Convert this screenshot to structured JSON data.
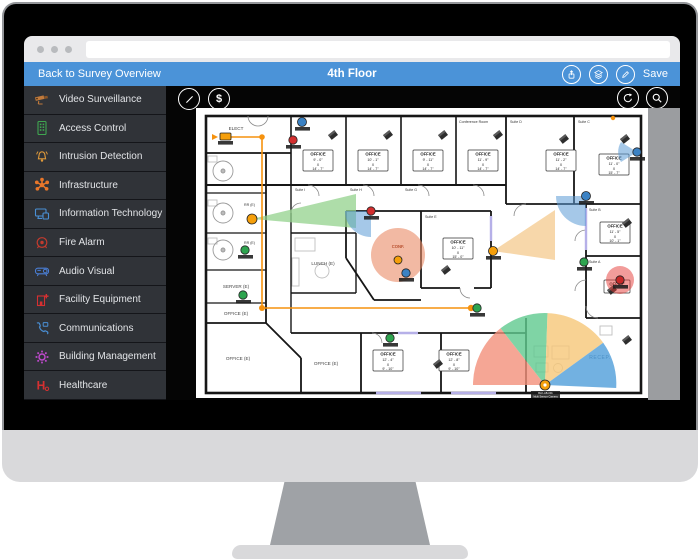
{
  "browser": {
    "url": ""
  },
  "header": {
    "back_label": "Back to Survey Overview",
    "title": "4th Floor",
    "save_label": "Save",
    "color": "#4b93d8",
    "icons": [
      "share-icon",
      "layers-icon",
      "edit-icon"
    ]
  },
  "sidebar": {
    "items": [
      {
        "label": "Video Surveillance",
        "color": "#c07a3c"
      },
      {
        "label": "Access Control",
        "color": "#3fa650"
      },
      {
        "label": "Intrusion Detection",
        "color": "#e09a3a"
      },
      {
        "label": "Infrastructure",
        "color": "#e8762a"
      },
      {
        "label": "Information Technology",
        "color": "#4a90d6"
      },
      {
        "label": "Fire Alarm",
        "color": "#c23b2e"
      },
      {
        "label": "Audio Visual",
        "color": "#4a7fd6"
      },
      {
        "label": "Facility Equipment",
        "color": "#d63031"
      },
      {
        "label": "Communications",
        "color": "#4a90d6"
      },
      {
        "label": "Building Management",
        "color": "#c34ad1"
      },
      {
        "label": "Healthcare",
        "color": "#d63031"
      }
    ]
  },
  "canvas_toolbar": {
    "dollar": "$",
    "icons": [
      "line-tool-icon",
      "budget-icon",
      "rotate-icon",
      "zoom-icon"
    ]
  },
  "floorplan": {
    "colors": {
      "fan_salmon": "#f2907a",
      "fan_green": "#5fc98e",
      "fan_tan": "#f6c778",
      "fan_blue": "#4f9ed9",
      "cone_green": "#93d18c",
      "cone_tan": "#f4c98e",
      "wedge_blue": "#5b9bd5",
      "conf_circle": "#e98b66",
      "glow_red": "#e53935",
      "conduit": "#f6920e"
    },
    "rooms": {
      "elect": "ELECT",
      "server": "SERVER (E)",
      "lunch": "LUNCH (E)",
      "office_e": "OFFICE (E)",
      "rr": "RR (E)"
    },
    "suites": {
      "i": "Suite I",
      "h": "Suite H",
      "g": "Suite G",
      "e": "Suite E",
      "d": "Suite D",
      "c": "Suite C",
      "b": "Suite B",
      "a": "Suite A",
      "conference": "Conference Room"
    },
    "office_box_title": "OFFICE",
    "x_label": "X",
    "offices": [
      {
        "w": "9' - 0\"",
        "h": "14' - 7\""
      },
      {
        "w": "10' - 1\"",
        "h": "14' - 7\""
      },
      {
        "w": "9' - 11\"",
        "h": "14' - 7\""
      },
      {
        "w": "11' - 9\"",
        "h": "14' - 7\""
      },
      {
        "w": "11' - 2\"",
        "h": "14' - 7\""
      },
      {
        "w": "11' - 0\"",
        "h": "15' - 7\""
      },
      {
        "w": "10' - 11\"",
        "h": "15' - 0\""
      },
      {
        "w": "11' - 5\"",
        "h": "10' - 1\""
      },
      {
        "w": "12' - 4\"",
        "h": "9' - 10\""
      },
      {
        "w": "12' - 8\"",
        "h": "9' - 10\""
      }
    ],
    "labels": {
      "conf": "CONF.",
      "recep": "RECEP."
    },
    "device_label": {
      "line1": "BLK-AB-001",
      "line2": "Multi Sensor Camera"
    }
  }
}
